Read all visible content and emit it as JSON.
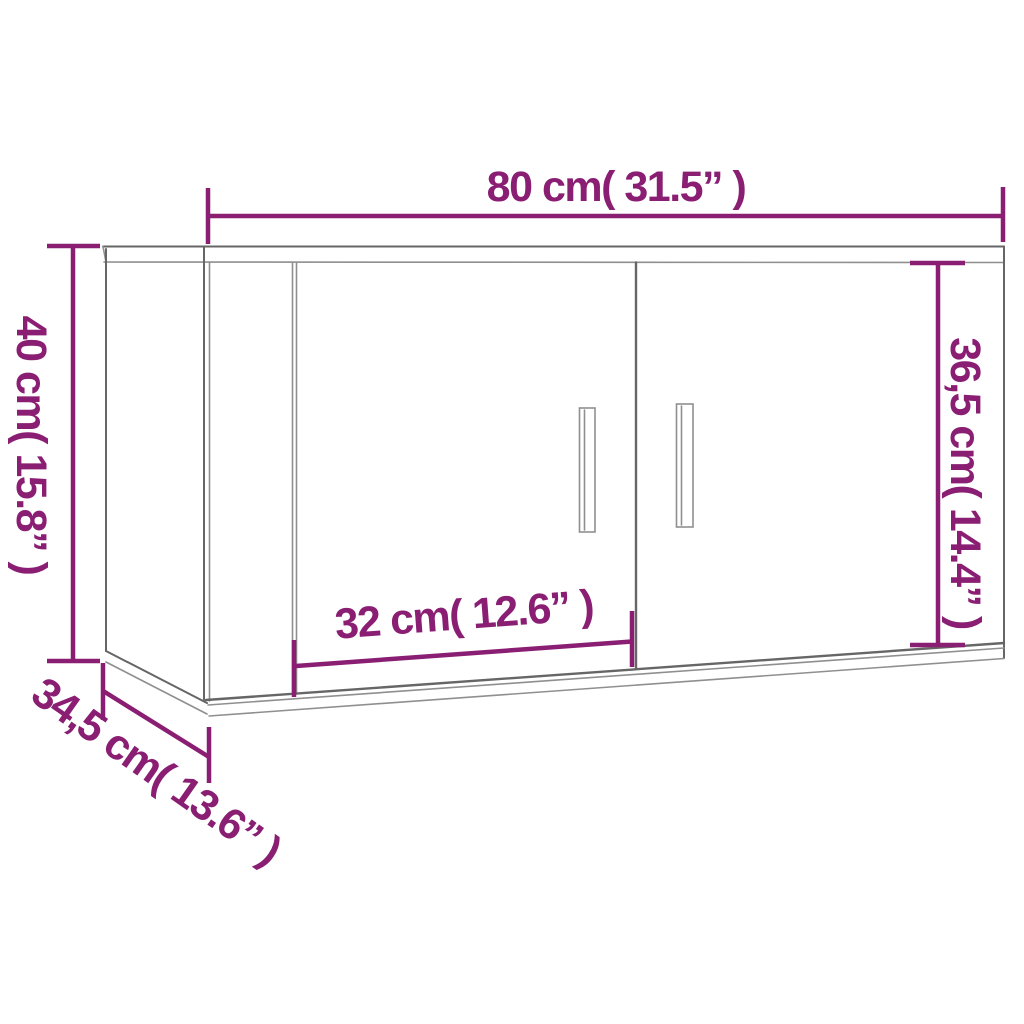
{
  "colors": {
    "accent": "#8A1E73",
    "line": "#666666",
    "line_soft": "#8f8f8f",
    "bg": "#ffffff"
  },
  "dimensions": {
    "width": {
      "label": "80 cm( 31.5” )"
    },
    "height": {
      "label": "40 cm( 15.8” )"
    },
    "door_height": {
      "label": "36,5 cm( 14.4” )"
    },
    "door_width": {
      "label": "32 cm( 12.6” )"
    },
    "depth": {
      "label": "34,5 cm( 13.6” )"
    }
  }
}
